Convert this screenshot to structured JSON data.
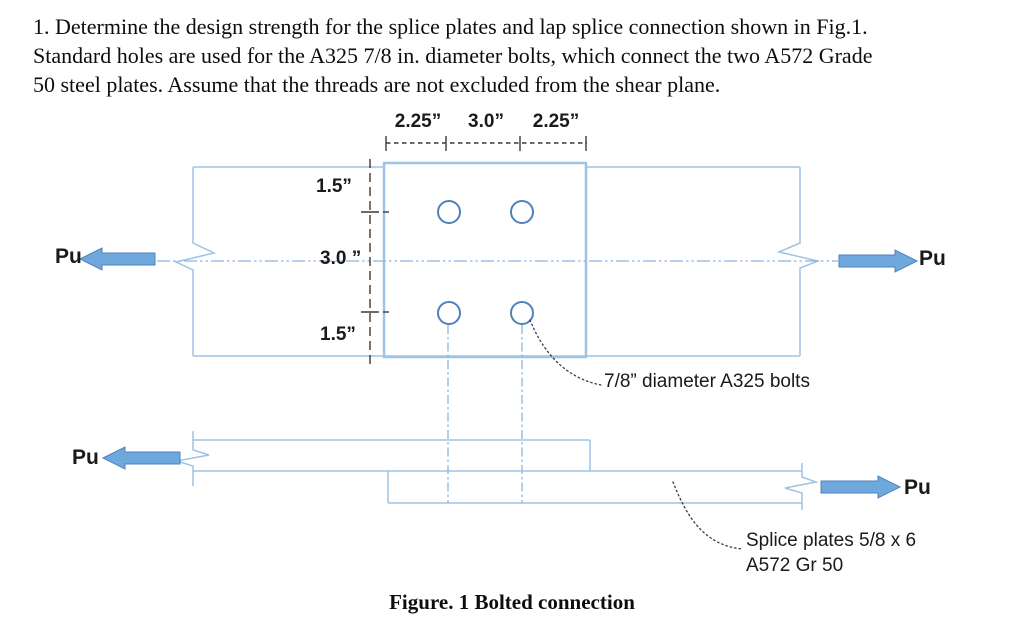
{
  "problem": {
    "lines": [
      "1. Determine the design strength for the splice plates and lap splice connection shown in Fig.1.",
      "Standard holes are used for the A325 7/8 in. diameter bolts, which connect the two A572 Grade",
      "50 steel plates. Assume that the threads are not excluded from the shear plane."
    ]
  },
  "figure": {
    "caption": "Figure. 1 Bolted connection",
    "dimensions": {
      "top_left": "2.25”",
      "top_mid": "3.0”",
      "top_right": "2.25”",
      "edge_top": "1.5”",
      "gauge_mid": "3.0 ”",
      "edge_bottom": "1.5”"
    },
    "labels": {
      "pu": "Pu",
      "bolts_note": "7/8” diameter A325 bolts",
      "splice_note_line1": "Splice plates 5/8 x 6",
      "splice_note_line2": "A572 Gr 50"
    },
    "colors": {
      "plate_line": "#9dc3e6",
      "splice_line": "#9dc3e6",
      "bolt_circle": "#4f81bd",
      "centerline": "#8eb4e3",
      "arrow_fill": "#6fa8dc",
      "arrow_border": "#4f81bd",
      "dashed_black": "#3a3a3a"
    }
  }
}
